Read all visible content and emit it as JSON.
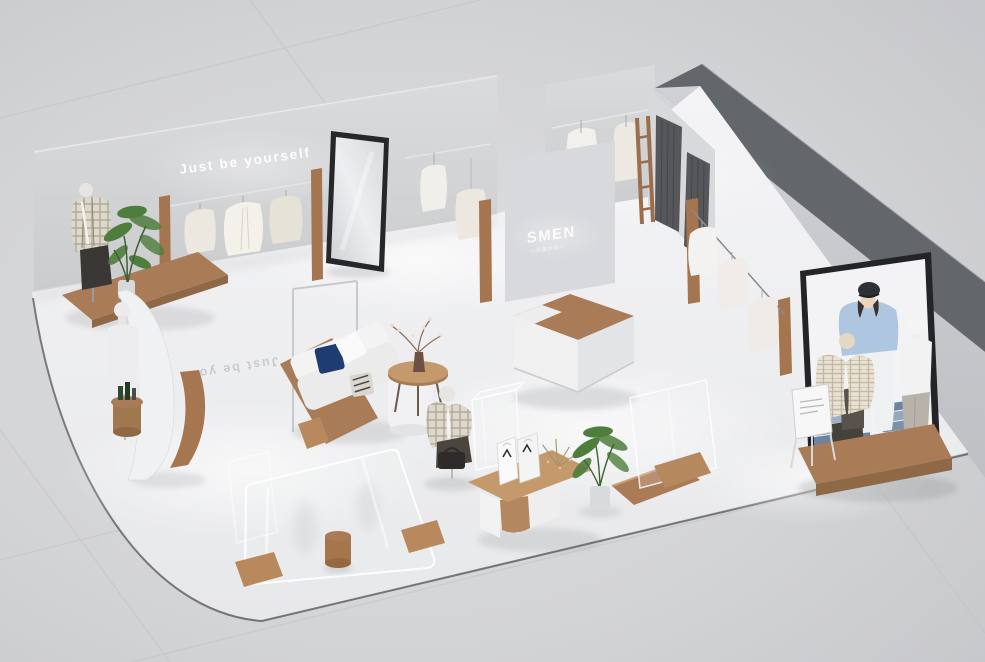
{
  "scene": {
    "description": "Isometric 3D render of a minimalist women's clothing boutique interior",
    "wall_slogan": "Just be yourself",
    "floor_slogan_mirrored": "Just be yo",
    "brand_logo": "SMEN",
    "brand_tagline": "—诗曼女装—"
  },
  "colors": {
    "background": "#cfd0d3",
    "floor": "#f0f1f3",
    "wall": "#d6d7d9",
    "dark_wall_top": "#63666b",
    "curtain": "#55575b",
    "wood": "#aa7b57",
    "wood_light": "#c49a6c",
    "navy_pillow": "#1f3c72",
    "plant_green": "#4e7d3c",
    "poster_sweater_blue": "#aec6e0",
    "mirror_frame": "#26272a"
  }
}
